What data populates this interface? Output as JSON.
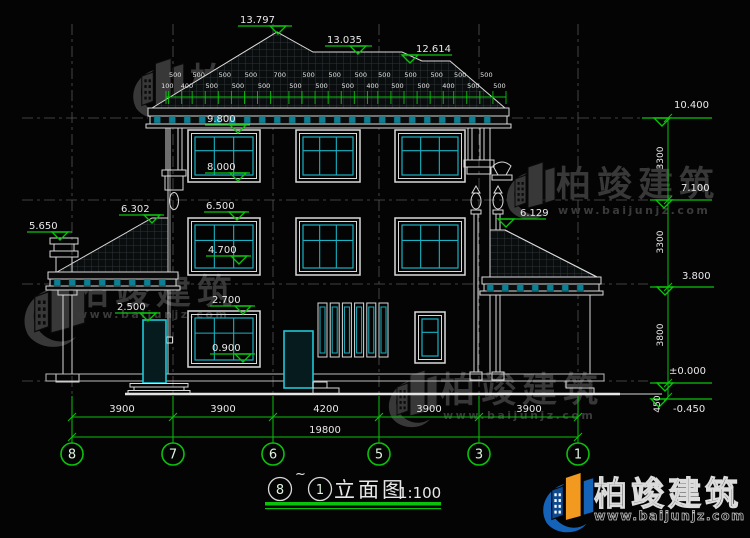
{
  "title_block": {
    "bubble_left": "8",
    "tilde": "~",
    "bubble_right": "1",
    "name": "立面图",
    "scale": "1:100"
  },
  "watermark": {
    "brand": "柏竣建筑",
    "url": "www.baijunjz.com"
  },
  "grid_bubbles": [
    "8",
    "7",
    "6",
    "5",
    "3",
    "1"
  ],
  "bottom_dims": {
    "segments": [
      "3900",
      "3900",
      "4200",
      "3900",
      "3900"
    ],
    "total": "19800"
  },
  "dimensions": {
    "eave_strip": {
      "x_start": 166,
      "x_end": 506,
      "y": 97,
      "values": [
        "100",
        "500",
        "400",
        "500",
        "500",
        "500",
        "500",
        "500",
        "500",
        "700",
        "500",
        "500",
        "500",
        "500",
        "500",
        "500",
        "400",
        "500",
        "500",
        "500",
        "500",
        "500",
        "400",
        "500",
        "500",
        "500",
        "500"
      ]
    },
    "elevation_markers": [
      {
        "label": "13.797",
        "x": 240,
        "y": 23,
        "lx1": 238,
        "lx2": 292,
        "ly": 26,
        "tx": 278
      },
      {
        "label": "13.035",
        "x": 327,
        "y": 43,
        "lx1": 325,
        "lx2": 372,
        "ly": 46,
        "tx": 358
      },
      {
        "label": "12.614",
        "x": 416,
        "y": 52,
        "lx1": 402,
        "lx2": 452,
        "ly": 55,
        "tx": 410
      },
      {
        "label": "9.800",
        "x": 207,
        "y": 122,
        "lx1": 205,
        "lx2": 250,
        "ly": 125,
        "tx": 238
      },
      {
        "label": "8.000",
        "x": 207,
        "y": 170,
        "lx1": 205,
        "lx2": 250,
        "ly": 173,
        "tx": 238
      },
      {
        "label": "6.500",
        "x": 206,
        "y": 209,
        "lx1": 204,
        "lx2": 249,
        "ly": 212,
        "tx": 237
      },
      {
        "label": "4.700",
        "x": 208,
        "y": 253,
        "lx1": 206,
        "lx2": 251,
        "ly": 256,
        "tx": 239
      },
      {
        "label": "2.700",
        "x": 212,
        "y": 303,
        "lx1": 210,
        "lx2": 255,
        "ly": 306,
        "tx": 243
      },
      {
        "label": "0.900",
        "x": 212,
        "y": 351,
        "lx1": 210,
        "lx2": 255,
        "ly": 354,
        "tx": 243
      },
      {
        "label": "2.500",
        "x": 117,
        "y": 310,
        "lx1": 115,
        "lx2": 160,
        "ly": 313,
        "tx": 148
      },
      {
        "label": "6.302",
        "x": 121,
        "y": 212,
        "lx1": 119,
        "lx2": 164,
        "ly": 215,
        "tx": 152
      },
      {
        "label": "5.650",
        "x": 29,
        "y": 229,
        "lx1": 27,
        "lx2": 72,
        "ly": 232,
        "tx": 60
      },
      {
        "label": "6.129",
        "x": 520,
        "y": 216,
        "lx1": 498,
        "lx2": 546,
        "ly": 219,
        "tx": 506
      },
      {
        "label": "10.400",
        "x": 674,
        "y": 108,
        "lx1": 642,
        "lx2": 712,
        "ly": 118,
        "tx": 662
      },
      {
        "label": "7.100",
        "x": 681,
        "y": 191,
        "lx1": 650,
        "lx2": 712,
        "ly": 200,
        "tx": 664
      },
      {
        "label": "3.800",
        "x": 682,
        "y": 279,
        "lx1": 650,
        "lx2": 714,
        "ly": 287,
        "tx": 665
      },
      {
        "label": "±0.000",
        "x": 669,
        "y": 374,
        "lx1": 650,
        "lx2": 712,
        "ly": 383,
        "tx": 665
      },
      {
        "label": "-0.450",
        "x": 673,
        "y": 412,
        "lx1": 666,
        "lx2": 712,
        "ly": 399,
        "tx": 659
      }
    ],
    "rotated_labels": [
      {
        "label": "3300",
        "x": 663,
        "y": 158
      },
      {
        "label": "3300",
        "x": 663,
        "y": 242
      },
      {
        "label": "3800",
        "x": 663,
        "y": 335
      },
      {
        "label": "450",
        "x": 660,
        "y": 404
      }
    ]
  },
  "drawing": {
    "windows": [
      {
        "x": 188,
        "y": 130,
        "w": 72,
        "h": 52,
        "kind": "big"
      },
      {
        "x": 296,
        "y": 130,
        "w": 64,
        "h": 52,
        "kind": "big"
      },
      {
        "x": 395,
        "y": 130,
        "w": 70,
        "h": 52,
        "kind": "big"
      },
      {
        "x": 188,
        "y": 218,
        "w": 72,
        "h": 57,
        "kind": "big"
      },
      {
        "x": 296,
        "y": 218,
        "w": 64,
        "h": 57,
        "kind": "big"
      },
      {
        "x": 395,
        "y": 218,
        "w": 70,
        "h": 57,
        "kind": "big"
      },
      {
        "x": 188,
        "y": 311,
        "w": 72,
        "h": 56,
        "kind": "big"
      },
      {
        "x": 415,
        "y": 312,
        "w": 30,
        "h": 51,
        "kind": "small"
      }
    ],
    "louvers": {
      "x": 318,
      "y": 303,
      "w": 9,
      "h": 54,
      "count": 6,
      "gap": 3.2
    },
    "rafter_rows": [
      {
        "x1": 154,
        "x2": 502,
        "y": 116.5,
        "step": 15
      },
      {
        "x1": 54,
        "x2": 172,
        "y": 279.5,
        "step": 15
      },
      {
        "x1": 487,
        "x2": 595,
        "y": 284.5,
        "step": 15
      }
    ]
  },
  "colors": {
    "green": "#0bc20b",
    "cyan": "#18b2c3",
    "teal_fill": "#0c7f92",
    "line_white": "#d9d9d9",
    "wm_gray": "#383838",
    "logo_blue": "#1563b8",
    "logo_dark_blue": "#0d4a8f",
    "logo_orange": "#f2991f"
  }
}
